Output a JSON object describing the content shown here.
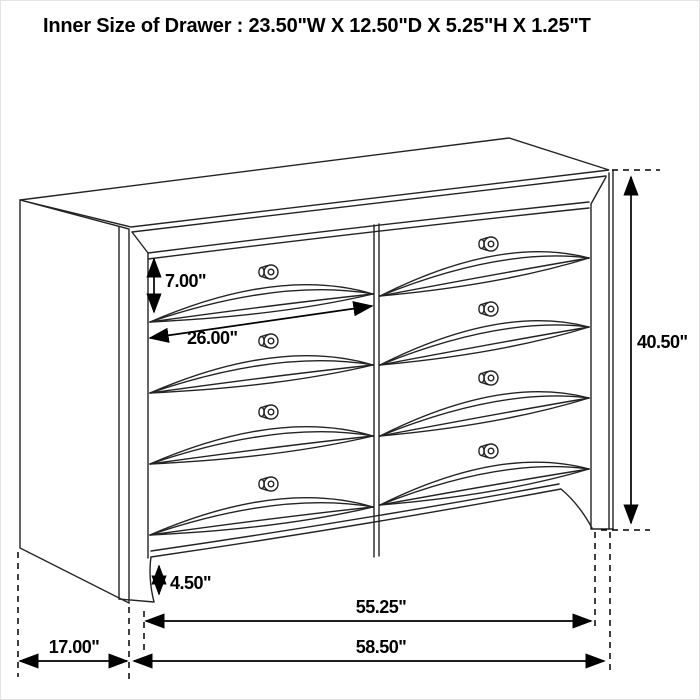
{
  "title": "Inner Size of Drawer : 23.50\"W X 12.50\"D X 5.25\"H X 1.25\"T",
  "dimensions": {
    "drawer_front_height": "7.00\"",
    "drawer_width": "26.00\"",
    "overall_height": "40.50\"",
    "base_clearance": "4.50\"",
    "case_width": "55.25\"",
    "overall_width": "58.50\"",
    "side_depth": "17.00\""
  }
}
